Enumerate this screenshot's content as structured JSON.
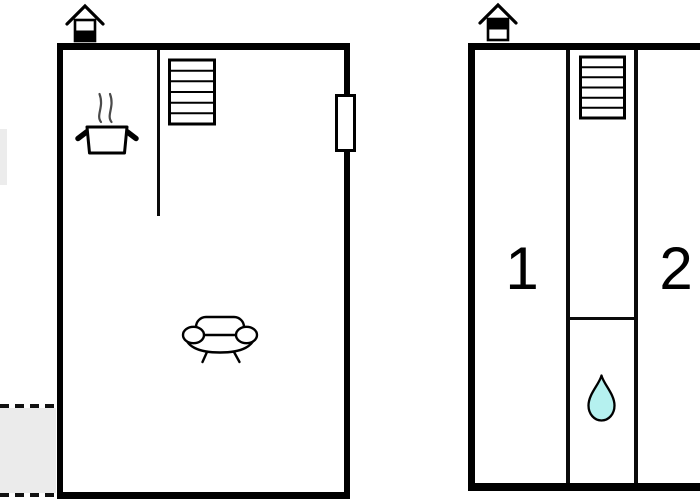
{
  "drawing": {
    "kind": "two-unit vacation-home floor plan",
    "units": {
      "left": {
        "rooms_shown": "kitchen with stove, staircase, living room with sofa, terrace (dashed outline)",
        "label_text": ""
      },
      "right": {
        "room1_label": "1",
        "room2_label": "2",
        "rooms_shown": "room 1, room 2, corridor with staircase, bathroom with water drop"
      }
    }
  },
  "icons": {
    "chimney_left": "house-with-chimney symbol, lower half of body filled black",
    "chimney_right": "house-with-chimney symbol, upper half of body filled black",
    "stairs": "staircase with 6 treads",
    "cooking_pot": "steaming cooking pot (kitchen)",
    "sofa": "sofa with two round armrests (living room)",
    "water_drop": "water drop (bathroom / water point)",
    "window": "window opening in right wall",
    "terrace": "grey dashed-edge terrace area"
  },
  "counts": {
    "stairs_treads_left": 6,
    "stairs_treads_right": 6
  },
  "colors": {
    "wall": "#000000",
    "background": "#ffffff",
    "terrace_fill": "#ebebeb",
    "edge_area_fill": "#ececec",
    "water_drop_fill": "#b5f1ef",
    "steam": "#4a4a4a"
  }
}
